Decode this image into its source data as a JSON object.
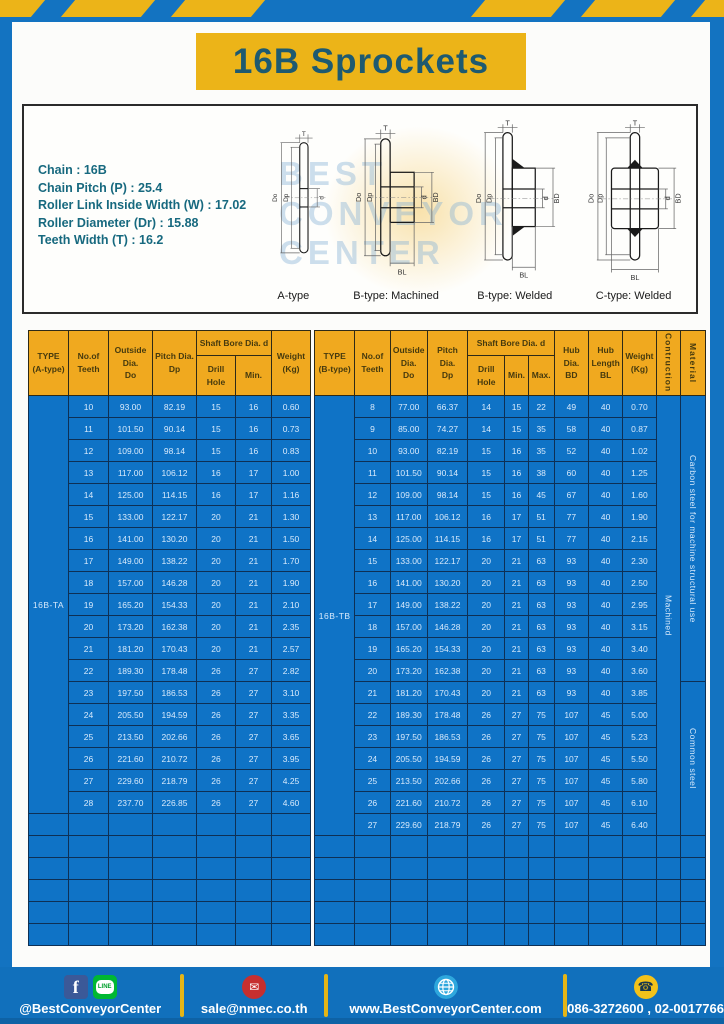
{
  "page": {
    "title": "16B Sprockets"
  },
  "spec_box": {
    "lines": [
      "Chain : 16B",
      "Chain Pitch (P) : 25.4",
      "Roller Link Inside Width (W) : 17.02",
      "Roller Diameter (Dr) : 15.88",
      "Teeth Width (T) : 16.2"
    ],
    "watermark": "Best Conveyor Center",
    "diagram_captions": [
      "A-type",
      "B-type: Machined",
      "B-type: Welded",
      "C-type: Welded"
    ],
    "dim_labels": {
      "t": "T",
      "do": "Do",
      "dp": "Dp",
      "d": "d",
      "bd": "BD",
      "bl": "BL"
    }
  },
  "table_a": {
    "headers": {
      "type": "TYPE\n(A-type)",
      "teeth": "No.of\nTeeth",
      "outside": "Outside\nDia.\nDo",
      "pitch": "Pitch Dia.\nDp",
      "bore_group": "Shaft Bore Dia. d",
      "drill": "Drill Hole",
      "min": "Min.",
      "weight": "Weight\n(Kg)"
    },
    "type_label": "16B-TA",
    "rows": [
      [
        "10",
        "93.00",
        "82.19",
        "15",
        "16",
        "0.60"
      ],
      [
        "11",
        "101.50",
        "90.14",
        "15",
        "16",
        "0.73"
      ],
      [
        "12",
        "109.00",
        "98.14",
        "15",
        "16",
        "0.83"
      ],
      [
        "13",
        "117.00",
        "106.12",
        "16",
        "17",
        "1.00"
      ],
      [
        "14",
        "125.00",
        "114.15",
        "16",
        "17",
        "1.16"
      ],
      [
        "15",
        "133.00",
        "122.17",
        "20",
        "21",
        "1.30"
      ],
      [
        "16",
        "141.00",
        "130.20",
        "20",
        "21",
        "1.50"
      ],
      [
        "17",
        "149.00",
        "138.22",
        "20",
        "21",
        "1.70"
      ],
      [
        "18",
        "157.00",
        "146.28",
        "20",
        "21",
        "1.90"
      ],
      [
        "19",
        "165.20",
        "154.33",
        "20",
        "21",
        "2.10"
      ],
      [
        "20",
        "173.20",
        "162.38",
        "20",
        "21",
        "2.35"
      ],
      [
        "21",
        "181.20",
        "170.43",
        "20",
        "21",
        "2.57"
      ],
      [
        "22",
        "189.30",
        "178.48",
        "26",
        "27",
        "2.82"
      ],
      [
        "23",
        "197.50",
        "186.53",
        "26",
        "27",
        "3.10"
      ],
      [
        "24",
        "205.50",
        "194.59",
        "26",
        "27",
        "3.35"
      ],
      [
        "25",
        "213.50",
        "202.66",
        "26",
        "27",
        "3.65"
      ],
      [
        "26",
        "221.60",
        "210.72",
        "26",
        "27",
        "3.95"
      ],
      [
        "27",
        "229.60",
        "218.79",
        "26",
        "27",
        "4.25"
      ],
      [
        "28",
        "237.70",
        "226.85",
        "26",
        "27",
        "4.60"
      ]
    ],
    "empty_rows": 6
  },
  "table_b": {
    "headers": {
      "type": "TYPE\n(B-type)",
      "teeth": "No.of\nTeeth",
      "outside": "Outside\nDia.\nDo",
      "pitch": "Pitch Dia.\nDp",
      "bore_group": "Shaft Bore Dia. d",
      "drill": "Drill Hole",
      "min": "Min.",
      "max": "Max.",
      "hub_dia": "Hub Dia.\nBD",
      "hub_len": "Hub\nLength\nBL",
      "weight": "Weight\n(Kg)",
      "construction": "Contruction",
      "material": "Material"
    },
    "type_label": "16B-TB",
    "construction_value": "Machined",
    "material": {
      "upper": "Carbon steel for machine structural use",
      "upper_rows": 13,
      "lower": "Common steel",
      "lower_rows": 7
    },
    "rows": [
      [
        "8",
        "77.00",
        "66.37",
        "14",
        "15",
        "22",
        "49",
        "40",
        "0.70"
      ],
      [
        "9",
        "85.00",
        "74.27",
        "14",
        "15",
        "35",
        "58",
        "40",
        "0.87"
      ],
      [
        "10",
        "93.00",
        "82.19",
        "15",
        "16",
        "35",
        "52",
        "40",
        "1.02"
      ],
      [
        "11",
        "101.50",
        "90.14",
        "15",
        "16",
        "38",
        "60",
        "40",
        "1.25"
      ],
      [
        "12",
        "109.00",
        "98.14",
        "15",
        "16",
        "45",
        "67",
        "40",
        "1.60"
      ],
      [
        "13",
        "117.00",
        "106.12",
        "16",
        "17",
        "51",
        "77",
        "40",
        "1.90"
      ],
      [
        "14",
        "125.00",
        "114.15",
        "16",
        "17",
        "51",
        "77",
        "40",
        "2.15"
      ],
      [
        "15",
        "133.00",
        "122.17",
        "20",
        "21",
        "63",
        "93",
        "40",
        "2.30"
      ],
      [
        "16",
        "141.00",
        "130.20",
        "20",
        "21",
        "63",
        "93",
        "40",
        "2.50"
      ],
      [
        "17",
        "149.00",
        "138.22",
        "20",
        "21",
        "63",
        "93",
        "40",
        "2.95"
      ],
      [
        "18",
        "157.00",
        "146.28",
        "20",
        "21",
        "63",
        "93",
        "40",
        "3.15"
      ],
      [
        "19",
        "165.20",
        "154.33",
        "20",
        "21",
        "63",
        "93",
        "40",
        "3.40"
      ],
      [
        "20",
        "173.20",
        "162.38",
        "20",
        "21",
        "63",
        "93",
        "40",
        "3.60"
      ],
      [
        "21",
        "181.20",
        "170.43",
        "20",
        "21",
        "63",
        "93",
        "40",
        "3.85"
      ],
      [
        "22",
        "189.30",
        "178.48",
        "26",
        "27",
        "75",
        "107",
        "45",
        "5.00"
      ],
      [
        "23",
        "197.50",
        "186.53",
        "26",
        "27",
        "75",
        "107",
        "45",
        "5.23"
      ],
      [
        "24",
        "205.50",
        "194.59",
        "26",
        "27",
        "75",
        "107",
        "45",
        "5.50"
      ],
      [
        "25",
        "213.50",
        "202.66",
        "26",
        "27",
        "75",
        "107",
        "45",
        "5.80"
      ],
      [
        "26",
        "221.60",
        "210.72",
        "26",
        "27",
        "75",
        "107",
        "45",
        "6.10"
      ],
      [
        "27",
        "229.60",
        "218.79",
        "26",
        "27",
        "75",
        "107",
        "45",
        "6.40"
      ]
    ],
    "empty_rows": 5
  },
  "footer": {
    "facebook_glyph": "f",
    "line_label": "LINE",
    "email_glyph": "✉",
    "phone_glyph": "☎",
    "social_handle": "@BestConveyorCenter",
    "email": "sale@nmec.co.th",
    "website": "www.BestConveyorCenter.com",
    "phone": "086-3272600 , 02-0017766"
  },
  "colors": {
    "frame_blue": "#1373c1",
    "banner_yellow": "#ecb418",
    "table_blue": "#0f73c6",
    "header_orange": "#f0a91f",
    "title_teal": "#1e5a70"
  }
}
